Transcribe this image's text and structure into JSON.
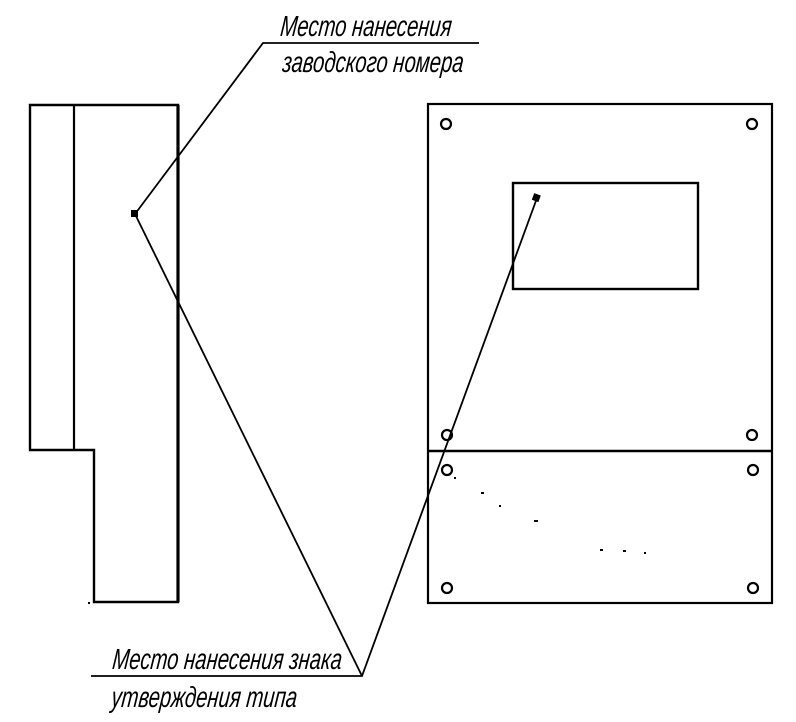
{
  "annotations": {
    "serial_number_label": {
      "line1": "Место нанесения",
      "line2": "заводского номера"
    },
    "type_approval_label": {
      "line1": "Место нанесения знака",
      "line2": "утверждения типа"
    }
  },
  "colors": {
    "line": "#000000",
    "background": "#ffffff"
  }
}
